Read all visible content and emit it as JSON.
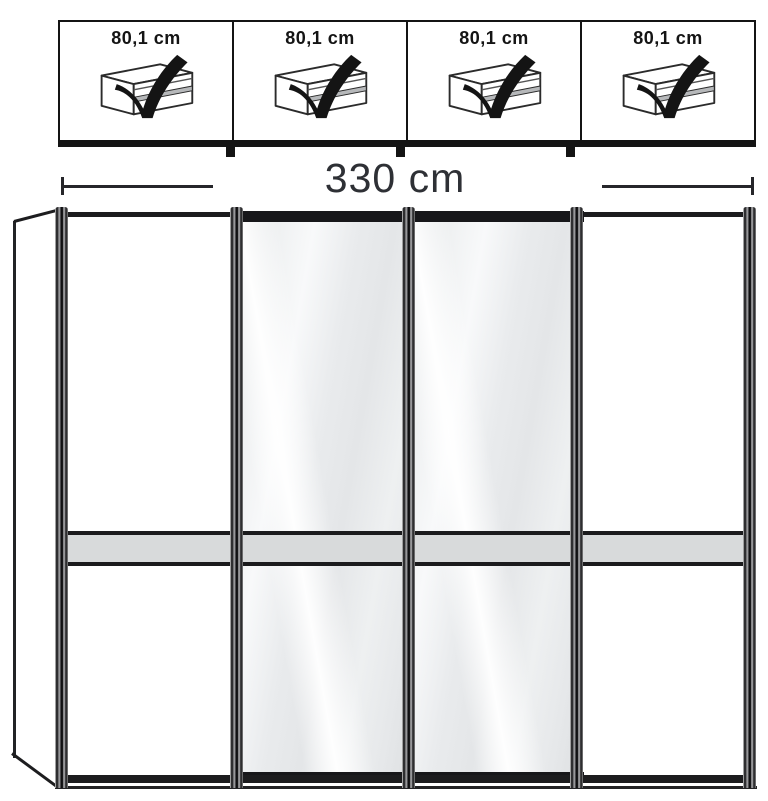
{
  "diagram": {
    "spec_row": {
      "cells": [
        {
          "label": "80,1 cm",
          "icon": "drawer-with-checkmark"
        },
        {
          "label": "80,1 cm",
          "icon": "drawer-with-checkmark"
        },
        {
          "label": "80,1 cm",
          "icon": "drawer-with-checkmark"
        },
        {
          "label": "80,1 cm",
          "icon": "drawer-with-checkmark"
        }
      ]
    },
    "dimension": {
      "total_width_label": "330 cm"
    },
    "wardrobe": {
      "door_count": 4,
      "doors": [
        {
          "position": 1,
          "type": "panel"
        },
        {
          "position": 2,
          "type": "mirror"
        },
        {
          "position": 3,
          "type": "mirror"
        },
        {
          "position": 4,
          "type": "panel"
        }
      ]
    },
    "colors": {
      "frame": "#1b1b1d",
      "mirror_base": "#e8eaec",
      "crossbar": "#d8dadb",
      "dimension_text": "#2e3035",
      "background": "#ffffff"
    }
  }
}
